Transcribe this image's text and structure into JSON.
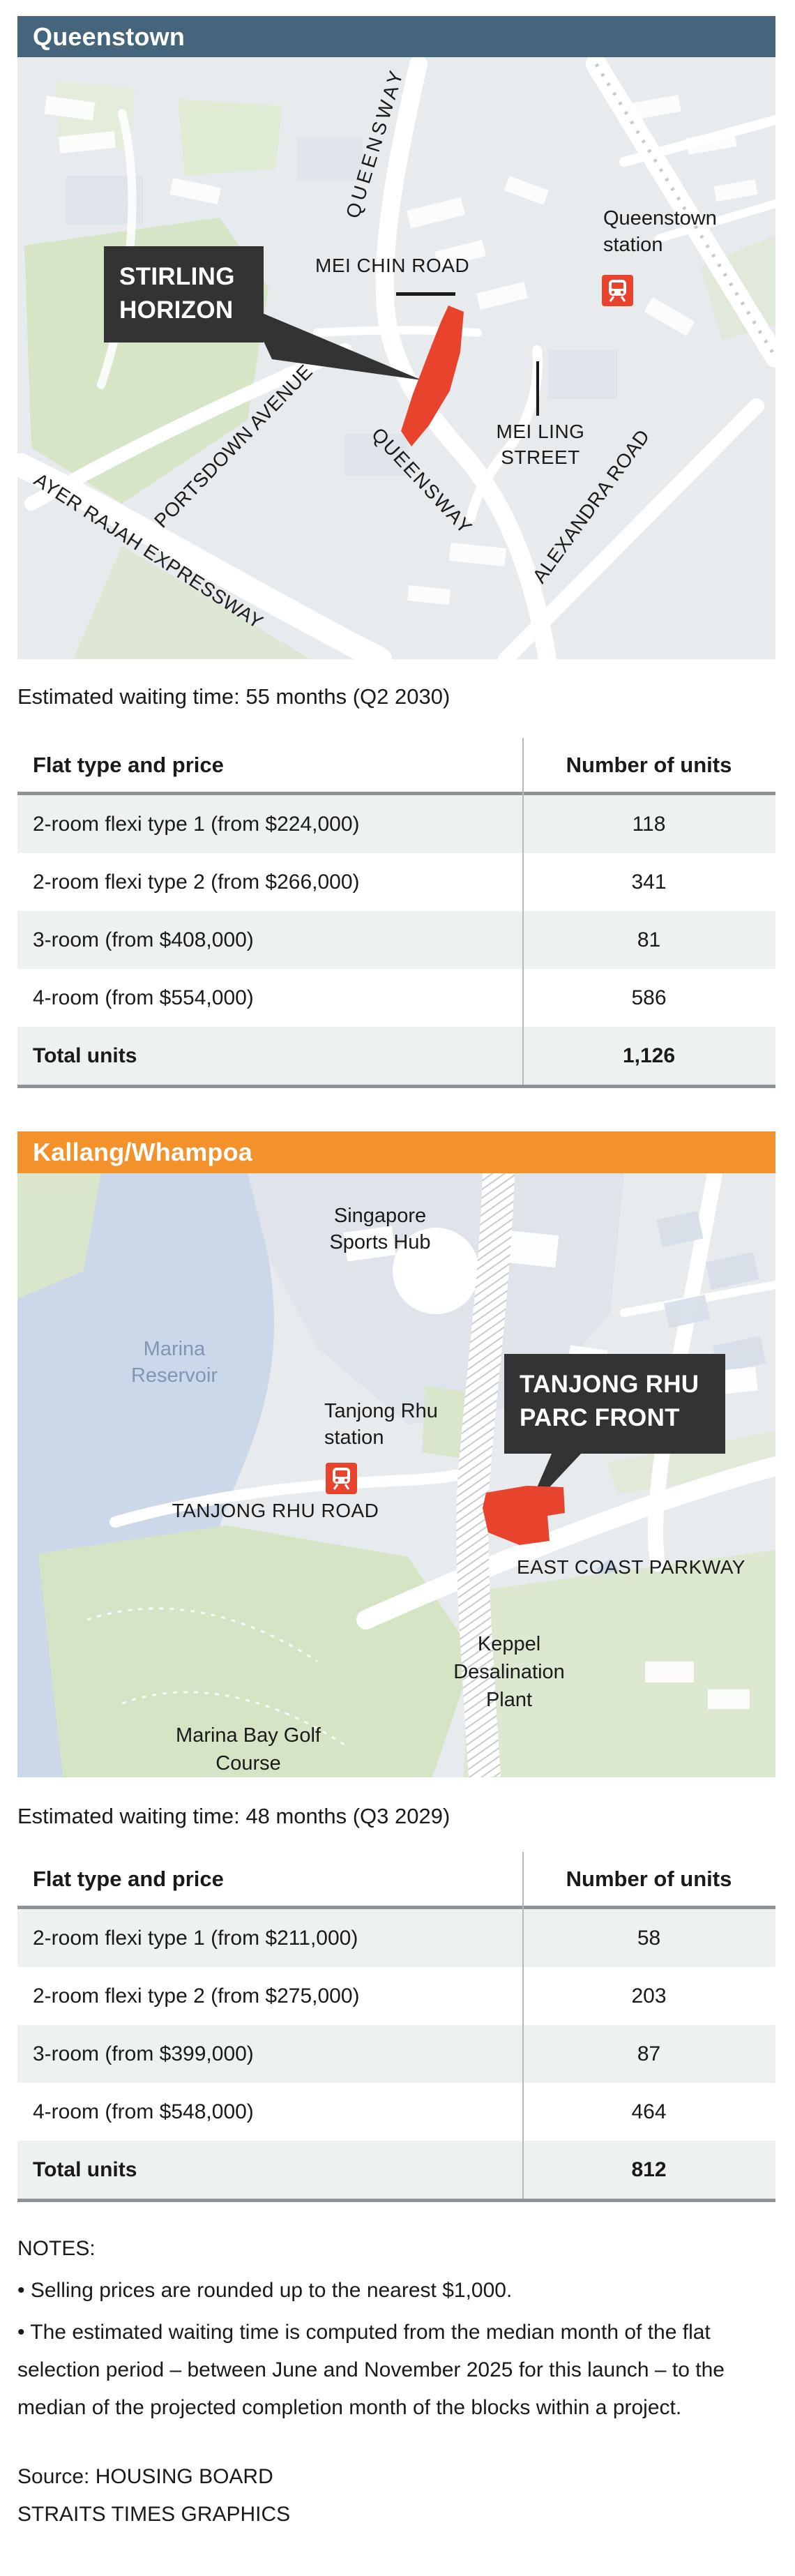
{
  "colors": {
    "queenstown_accent": "#44657B",
    "kallang_accent": "#F3922A",
    "site_red": "#E8432C",
    "callout_bg": "#333333",
    "map_bg": "#E8EBED",
    "water": "#CBD8E9",
    "park_green": "#D7E5C7",
    "row_alt_bg": "#EDF1F2",
    "rule_gray": "#8E9396",
    "reservoir_label_color": "#8295B5",
    "mrt_icon_red": "#E8432C"
  },
  "sections": [
    {
      "header": "Queenstown",
      "map": {
        "queensway_top": "QUEENSWAY",
        "station": "Queenstown station",
        "mei_chin_road": "MEI CHIN ROAD",
        "callout": "STIRLING HORIZON",
        "mei_ling_street": "MEI LING STREET",
        "portsdown": "PORTSDOWN AVENUE",
        "ayer_rajah": "AYER RAJAH EXPRESSWAY",
        "queensway_bottom": "QUEENSWAY",
        "alexandra": "ALEXANDRA ROAD"
      },
      "waiting": "Estimated waiting time: 55 months (Q2 2030)",
      "table": {
        "col1": "Flat type and price",
        "col2": "Number of units",
        "rows": [
          {
            "label": "2-room flexi type 1 (from $224,000)",
            "value": "118"
          },
          {
            "label": "2-room flexi type 2 (from $266,000)",
            "value": "341"
          },
          {
            "label": "3-room (from $408,000)",
            "value": "81"
          },
          {
            "label": "4-room (from $554,000)",
            "value": "586"
          }
        ],
        "total_label": "Total units",
        "total_value": "1,126"
      }
    },
    {
      "header": "Kallang/Whampoa",
      "map": {
        "sports_hub": "Singapore Sports Hub",
        "reservoir": "Marina Reservoir",
        "station": "Tanjong Rhu station",
        "callout": "TANJONG RHU PARC FRONT",
        "tanjong_rhu_road": "TANJONG RHU ROAD",
        "east_coast_parkway": "EAST COAST PARKWAY",
        "keppel": "Keppel Desalination Plant",
        "golf": "Marina Bay Golf Course"
      },
      "waiting": "Estimated waiting time: 48 months (Q3 2029)",
      "table": {
        "col1": "Flat type and price",
        "col2": "Number of units",
        "rows": [
          {
            "label": "2-room flexi type 1 (from $211,000)",
            "value": "58"
          },
          {
            "label": "2-room flexi type 2 (from $275,000)",
            "value": "203"
          },
          {
            "label": "3-room (from $399,000)",
            "value": "87"
          },
          {
            "label": "4-room (from $548,000)",
            "value": "464"
          }
        ],
        "total_label": "Total units",
        "total_value": "812"
      }
    }
  ],
  "notes": {
    "title": "NOTES:",
    "bullet1": "• Selling prices are rounded up to the nearest $1,000.",
    "bullet2": "• The estimated waiting time is computed from the median month of the flat selection period – between June and November 2025 for this launch – to the median of the projected completion month of the blocks within a project.",
    "source": "Source: HOUSING BOARD",
    "credit": "STRAITS TIMES GRAPHICS"
  }
}
